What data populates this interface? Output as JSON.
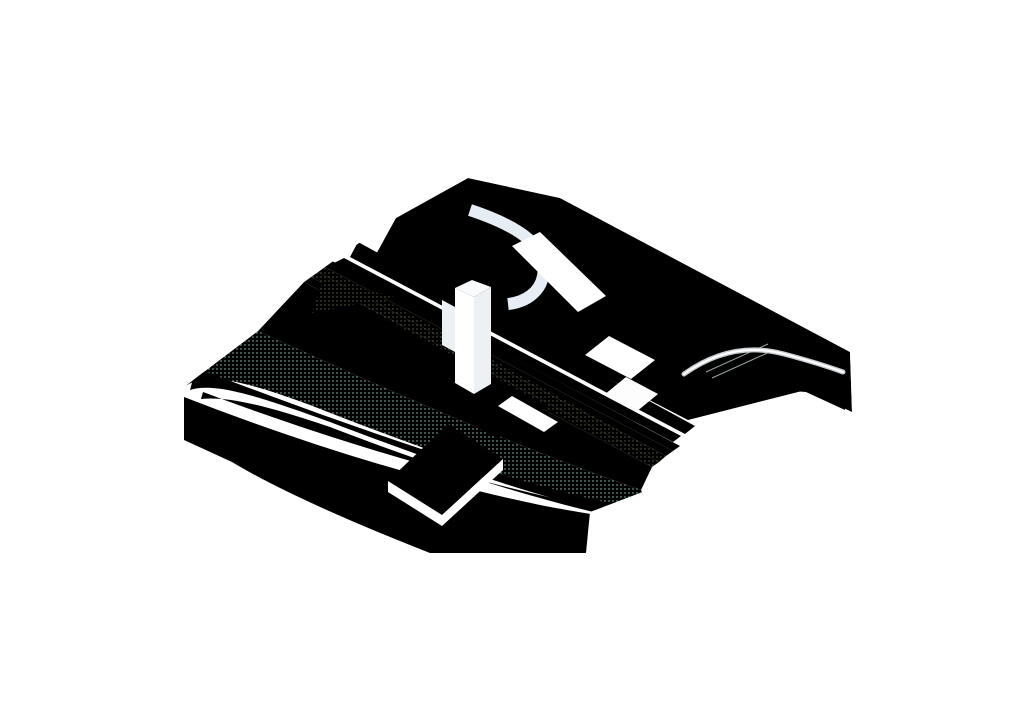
{
  "colors": {
    "background": "#ffffff",
    "outline": "#3f4447",
    "ghost_outline": "#b9bdc2",
    "water": "#53b3a1",
    "wave_mid": "#79c6b4",
    "wave_light": "#a9dbcd",
    "beach": "#d9ece6",
    "beach_dot": "#9fcfc0",
    "promenade": "#e7edf4",
    "lawn": "#cfe2b2",
    "lawn_back": "#c3d8a0",
    "slope1": "#e9efd2",
    "slope2": "#dbe8bd",
    "slope3": "#c9dda6",
    "slope4": "#b7d192",
    "wedge1": "#dcec9e",
    "wedge2": "#c8e07e",
    "garden_floor": "#cfe0ae",
    "steps_bg": "#e6e9ee",
    "steps_line": "#8f959b",
    "yellow_path": "#f8e2a0",
    "yellow_edge": "#ddc175",
    "yellow_dash": "#efae1f",
    "dark_hedge": "#5f7848",
    "railing": "#4a4f52",
    "railing_bg": "#eceff1",
    "reed": "#7d8f6e",
    "post": "#9aa59a",
    "green_dot": "#9bb878",
    "tree_dark": "#4c7d2f",
    "tree_mid": "#7ca55a",
    "tree_sage": "#95ad85",
    "trunk": "#6a7a5a",
    "figure": "#1c1e1f",
    "lamp": "#9ba1a6",
    "arrow_blue": "#6e97dc",
    "arrow_yellow": "#f3b21e"
  },
  "flows": [
    {
      "name": "main-axis-cycle-route",
      "color_key": "arrow_yellow",
      "width": 2.7,
      "dash": "3 4.4",
      "points": [
        [
          349,
          229
        ],
        [
          744,
          454
        ]
      ],
      "heads": "both"
    },
    {
      "name": "embankment-pedestrian-flow",
      "color_key": "arrow_blue",
      "width": 2.4,
      "dash": "2.8 4.2",
      "points": [
        [
          332,
          249
        ],
        [
          720,
          466
        ]
      ],
      "heads": "both"
    },
    {
      "name": "promenade-pedestrian-flow",
      "color_key": "arrow_blue",
      "width": 2.4,
      "dash": "2.8 4.2",
      "points": [
        [
          276,
          314
        ],
        [
          631,
          522
        ]
      ],
      "heads": "both"
    },
    {
      "name": "upper-street-pedestrian-flow",
      "color_key": "arrow_blue",
      "width": 2.4,
      "dash": "2.8 4.2",
      "points": [
        [
          470,
          184
        ],
        [
          580,
          243
        ],
        [
          660,
          300
        ],
        [
          727,
          339
        ],
        [
          833,
          390
        ]
      ],
      "heads": "both"
    },
    {
      "name": "cross-connection-to-pier",
      "color_key": "arrow_blue",
      "width": 2.4,
      "dash": "2.8 4.2",
      "points": [
        [
          373,
          528
        ],
        [
          763,
          302
        ]
      ],
      "heads": "both"
    }
  ],
  "trees": [
    {
      "x": 317,
      "y": 318,
      "c": "tree_sage",
      "s": 1.0
    },
    {
      "x": 372,
      "y": 355,
      "c": "tree_mid",
      "s": 0.95
    },
    {
      "x": 424,
      "y": 379,
      "c": "tree_mid",
      "s": 1.0
    },
    {
      "x": 481,
      "y": 412,
      "c": "tree_dark",
      "s": 0.9
    },
    {
      "x": 540,
      "y": 449,
      "c": "tree_mid",
      "s": 0.95
    },
    {
      "x": 597,
      "y": 471,
      "c": "tree_sage",
      "s": 0.9
    },
    {
      "x": 612,
      "y": 232,
      "c": "tree_dark",
      "s": 1.0
    },
    {
      "x": 666,
      "y": 257,
      "c": "tree_mid",
      "s": 1.0
    },
    {
      "x": 624,
      "y": 271,
      "c": "tree_mid",
      "s": 0.9
    },
    {
      "x": 646,
      "y": 312,
      "c": "tree_mid",
      "s": 0.95
    },
    {
      "x": 690,
      "y": 310,
      "c": "tree_sage",
      "s": 0.9
    },
    {
      "x": 798,
      "y": 348,
      "c": "tree_dark",
      "s": 1.0
    }
  ],
  "people": [
    [
      500,
      216
    ],
    [
      592,
      251
    ],
    [
      598,
      270
    ],
    [
      628,
      297
    ],
    [
      688,
      335
    ],
    [
      727,
      391
    ],
    [
      405,
      295
    ],
    [
      417,
      311
    ],
    [
      563,
      314
    ],
    [
      575,
      328
    ],
    [
      613,
      357
    ],
    [
      623,
      360
    ],
    [
      344,
      412
    ],
    [
      377,
      374
    ],
    [
      446,
      414
    ],
    [
      463,
      421
    ],
    [
      468,
      482
    ],
    [
      546,
      478
    ],
    [
      497,
      440
    ]
  ],
  "lamps": [
    [
      398,
      364
    ],
    [
      568,
      458
    ],
    [
      557,
      205
    ],
    [
      705,
      293
    ]
  ],
  "fences": [
    {
      "x1": 470,
      "y1": 186,
      "x2": 558,
      "y2": 205,
      "n": 9,
      "h": 14
    },
    {
      "x1": 558,
      "y1": 205,
      "x2": 846,
      "y2": 358,
      "n": 30,
      "h": 14
    },
    {
      "x1": 468,
      "y1": 214,
      "x2": 648,
      "y2": 308,
      "n": 19,
      "h": 14
    }
  ],
  "reed_patches": [
    {
      "name": "upper-meadow",
      "x": 470,
      "y": 200,
      "ux": 80,
      "uy": 46,
      "vx": -33,
      "vy": 19,
      "cols": 11,
      "rows": 5,
      "h": 12
    },
    {
      "name": "sunken-garden-reeds",
      "x": 700,
      "y": 350,
      "ux": 113,
      "uy": 62,
      "vx": -30,
      "vy": 17,
      "cols": 13,
      "rows": 5,
      "h": 19
    }
  ],
  "steps": {
    "x": 330,
    "y": 290,
    "ux": 218,
    "uy": 116,
    "ox": -3.4,
    "oy": 2.1,
    "n": 15
  },
  "path_markers": [
    [
      548,
      306
    ],
    [
      608,
      376
    ]
  ]
}
